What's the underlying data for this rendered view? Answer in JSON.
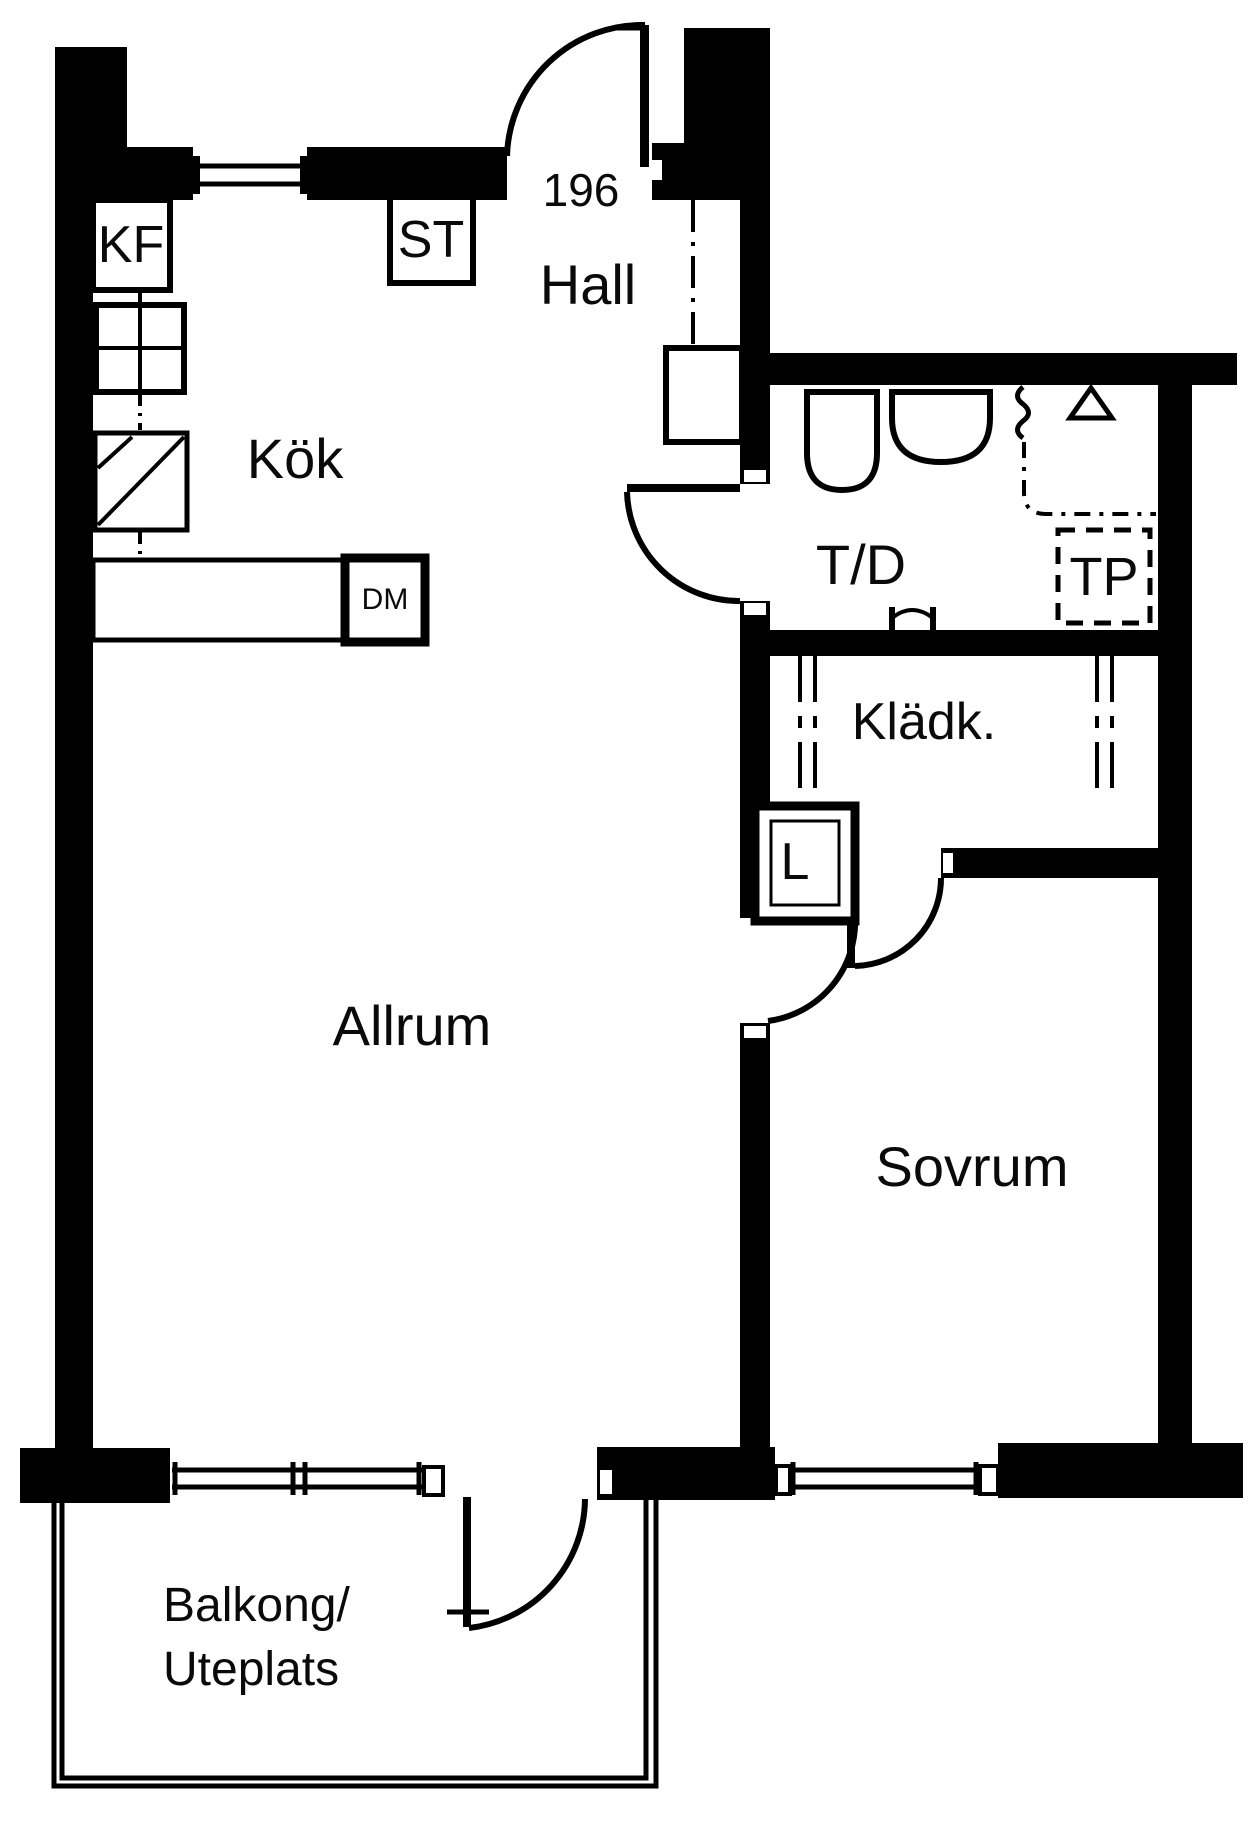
{
  "title": "Apartment floor plan",
  "apartment": {
    "number": "196"
  },
  "rooms": {
    "hall": {
      "label": "Hall"
    },
    "kitchen": {
      "label": "Kök"
    },
    "living_room": {
      "label": "Allrum"
    },
    "bedroom": {
      "label": "Sovrum"
    },
    "bathroom": {
      "label": "T/D"
    },
    "closet": {
      "label": "Klädk."
    },
    "balcony": {
      "label_line1": "Balkong/",
      "label_line2": "Uteplats"
    }
  },
  "fixtures": {
    "fridge_freezer": {
      "label": "KF"
    },
    "cleaning_cabinet": {
      "label": "ST"
    },
    "dishwasher": {
      "label": "DM"
    },
    "drying_cabinet": {
      "label": "TP"
    },
    "linen_cabinet": {
      "label": "L"
    }
  },
  "colors": {
    "ink": "#000000",
    "paper": "#ffffff"
  }
}
